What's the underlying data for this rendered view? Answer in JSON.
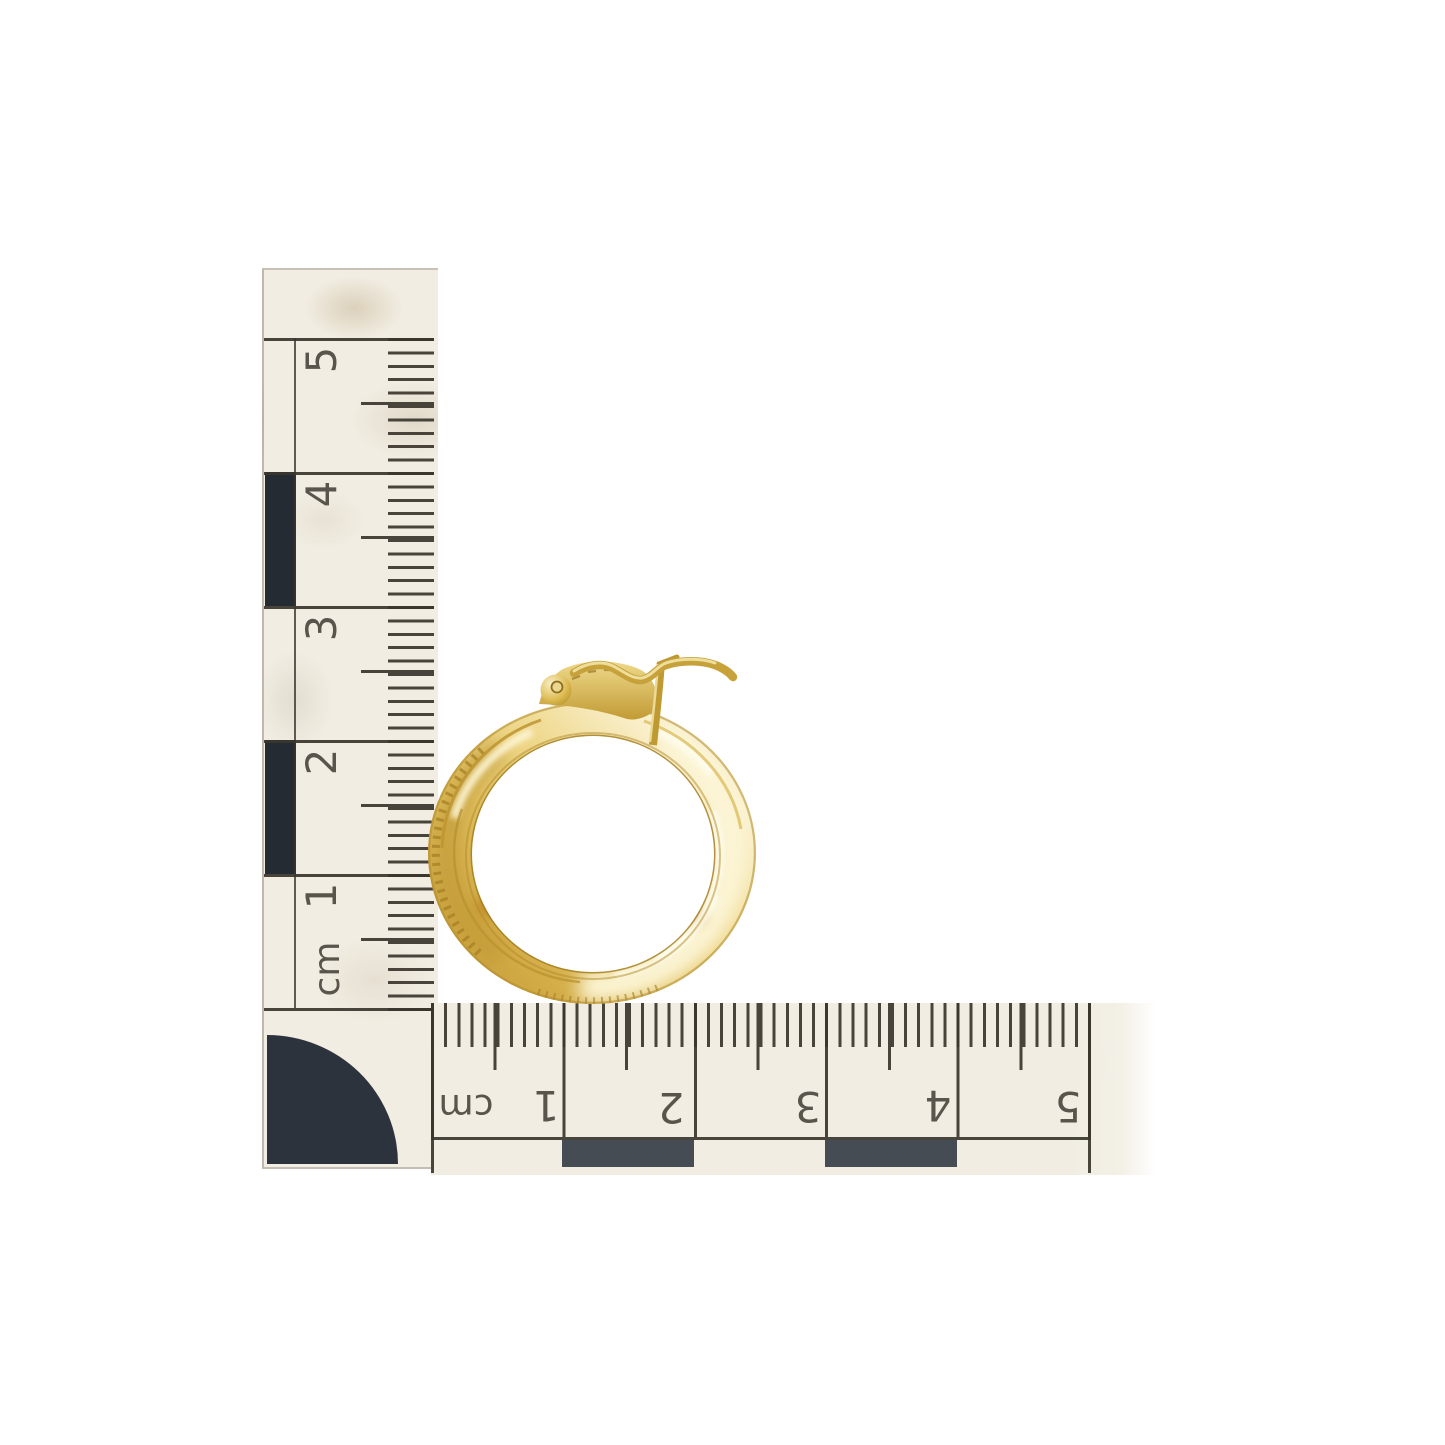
{
  "scene": {
    "description": "Gold hoop earring photographed against white with two centimetre scale rulers arranged in an L",
    "background_color": "#ffffff"
  },
  "vertical_ruler": {
    "orientation": "vertical",
    "unit_label": "cm",
    "tick_labels": [
      "5",
      "4",
      "3",
      "2",
      "1"
    ]
  },
  "horizontal_ruler": {
    "orientation": "horizontal",
    "unit_label": "cm",
    "tick_labels": [
      "1",
      "2",
      "3",
      "4",
      "5"
    ]
  },
  "earring": {
    "type": "gold hoop earring with latch-back clasp",
    "approx_outer_diameter_cm": 2.5,
    "material_colors": {
      "gold_highlight": "#faf2cf",
      "gold_mid": "#e2c15e",
      "gold_deep": "#c59d38",
      "gold_shadow": "#9a761e"
    }
  },
  "ruler_colors": {
    "paper": "#f1ede2",
    "ink": "#46423a",
    "checker_block_dark": "#252b33",
    "checker_block_gray": "#454c54"
  }
}
